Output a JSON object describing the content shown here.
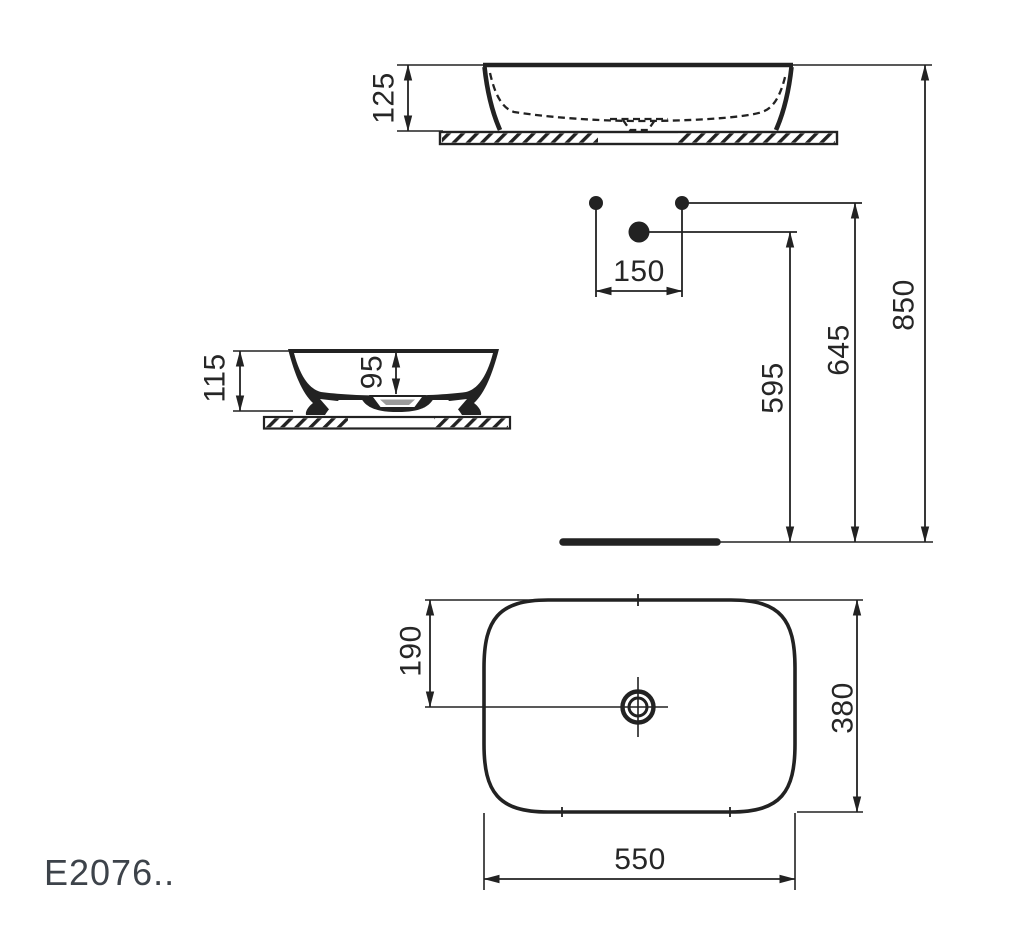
{
  "product_code": "E2076..",
  "colors": {
    "line": "#222222",
    "dim_text": "#262626",
    "code_text": "#3d434a",
    "drain_fill": "#9b9b9b"
  },
  "views": {
    "side_section": {
      "height": "125"
    },
    "installation": {
      "hole_spacing": "150",
      "drain_outlet_height": "595",
      "supply_height": "645",
      "rim_height": "850"
    },
    "front_section": {
      "overall_height": "115",
      "bowl_depth": "95"
    },
    "plan": {
      "drain_offset": "190",
      "overall_depth": "380",
      "overall_width": "550"
    }
  }
}
